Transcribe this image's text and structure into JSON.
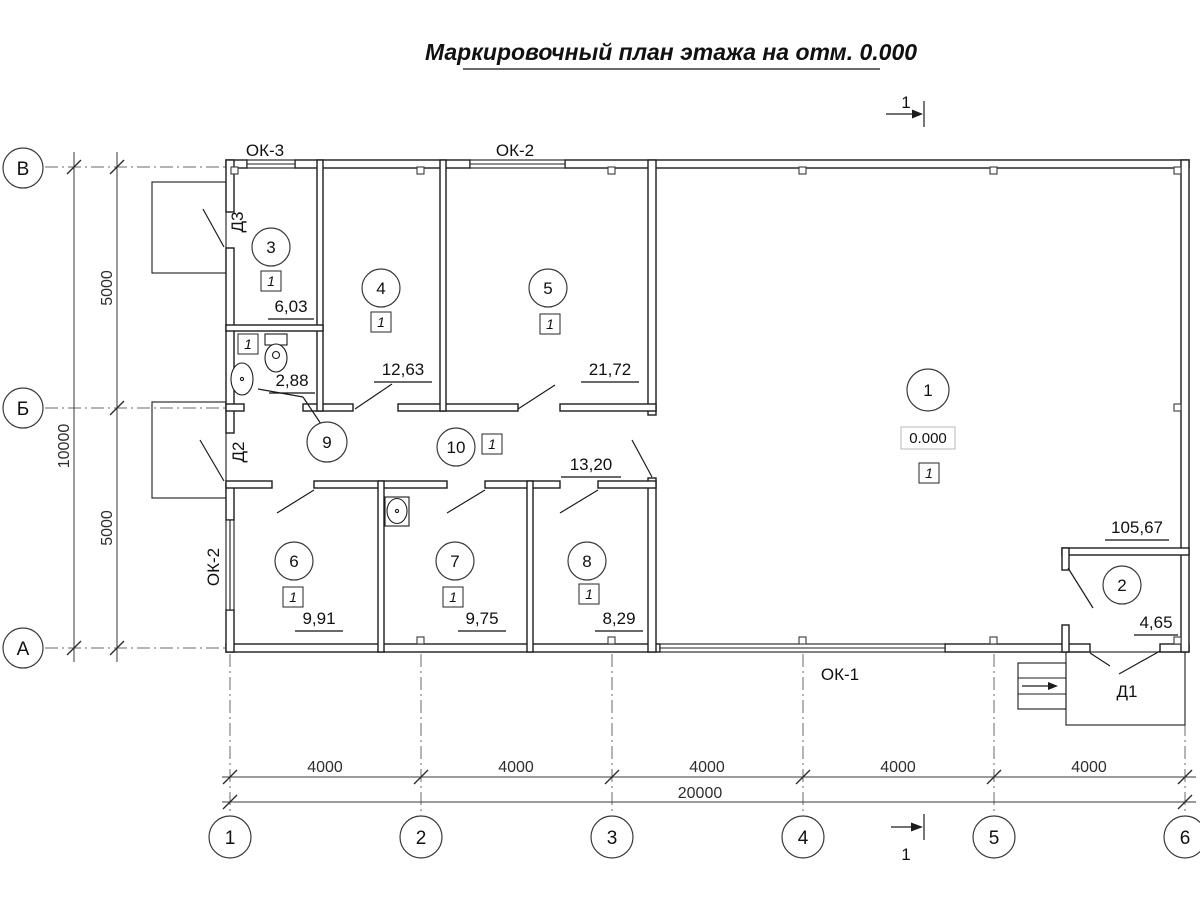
{
  "title": {
    "text": "Маркировочный план этажа на отм. 0.000"
  },
  "section_mark": {
    "label": "1"
  },
  "axes": {
    "columns": [
      "1",
      "2",
      "3",
      "4",
      "5",
      "6"
    ],
    "rows": [
      "В",
      "Б",
      "А"
    ]
  },
  "dimensions": {
    "bays": [
      "4000",
      "4000",
      "4000",
      "4000",
      "4000"
    ],
    "total_width": "20000",
    "row_spans": [
      "5000",
      "5000"
    ],
    "total_height": "10000"
  },
  "windows": {
    "ok3": "ОК-3",
    "ok2_top": "ОК-2",
    "ok2_left": "ОК-2",
    "ok1": "ОК-1"
  },
  "doors": {
    "d3": "Д3",
    "d2": "Д2",
    "d1": "Д1"
  },
  "elevation": {
    "value": "0.000"
  },
  "rooms": [
    {
      "number": "1",
      "floor_type": "1",
      "area": "105,67"
    },
    {
      "number": "2",
      "area": "4,65"
    },
    {
      "number": "3",
      "floor_type": "1",
      "area": "6,03"
    },
    {
      "number": "4",
      "floor_type": "1",
      "area": "12,63"
    },
    {
      "number": "5",
      "floor_type": "1",
      "area": "21,72"
    },
    {
      "number": "6",
      "floor_type": "1",
      "area": "9,91"
    },
    {
      "number": "7",
      "floor_type": "1",
      "area": "9,75"
    },
    {
      "number": "8",
      "floor_type": "1",
      "area": "8,29"
    },
    {
      "number": "9",
      "floor_type": "1",
      "area": "2,88"
    },
    {
      "number": "10",
      "floor_type": "1",
      "area": "13,20"
    }
  ]
}
